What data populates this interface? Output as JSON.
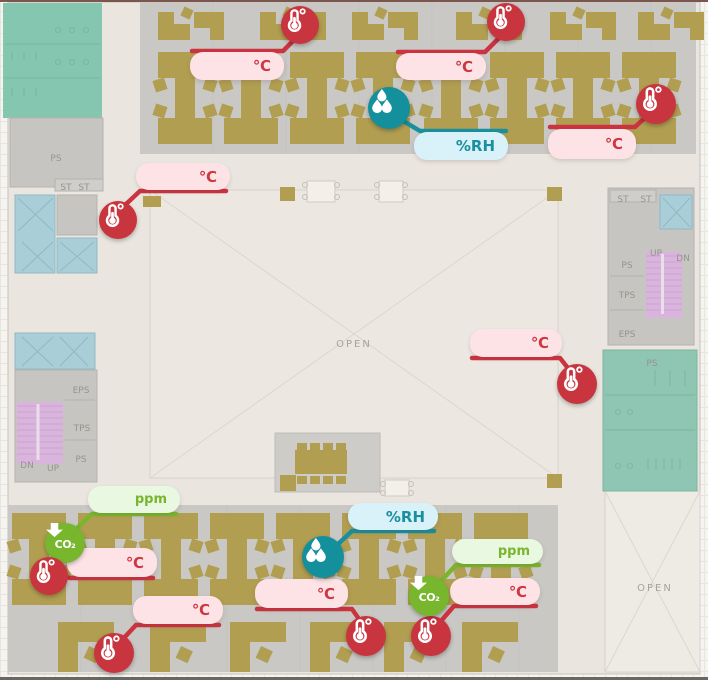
{
  "plan": {
    "atrium_label": "OPEN",
    "open_area_label": "OPEN",
    "labels": {
      "ps": "PS",
      "eps": "EPS",
      "tps": "TPS",
      "st": "ST",
      "up": "UP",
      "dn": "DN"
    }
  },
  "sensors": {
    "temperature": {
      "unit": "℃",
      "accent": "#c8353f",
      "pill_bg": "#fde3e6",
      "count": 9
    },
    "humidity": {
      "unit": "%RH",
      "accent": "#1a8f9d",
      "pill_bg": "#d9f1f9",
      "count": 2
    },
    "co2": {
      "unit": "ppm",
      "accent": "#77b62d",
      "pill_bg": "#e8f8e1",
      "icon_label": "CO₂",
      "count": 2
    }
  },
  "colors": {
    "building_bg": "#eae6df",
    "office_floor": "#c9c8c5",
    "desk": "#b19e51",
    "restroom": "#85c6b1",
    "elevator": "#a9ced8",
    "stairs": "#d9b4dd",
    "temp_line": "#cc3340",
    "hum_line": "#1a8f9d",
    "co2_line": "#7ab62d"
  }
}
